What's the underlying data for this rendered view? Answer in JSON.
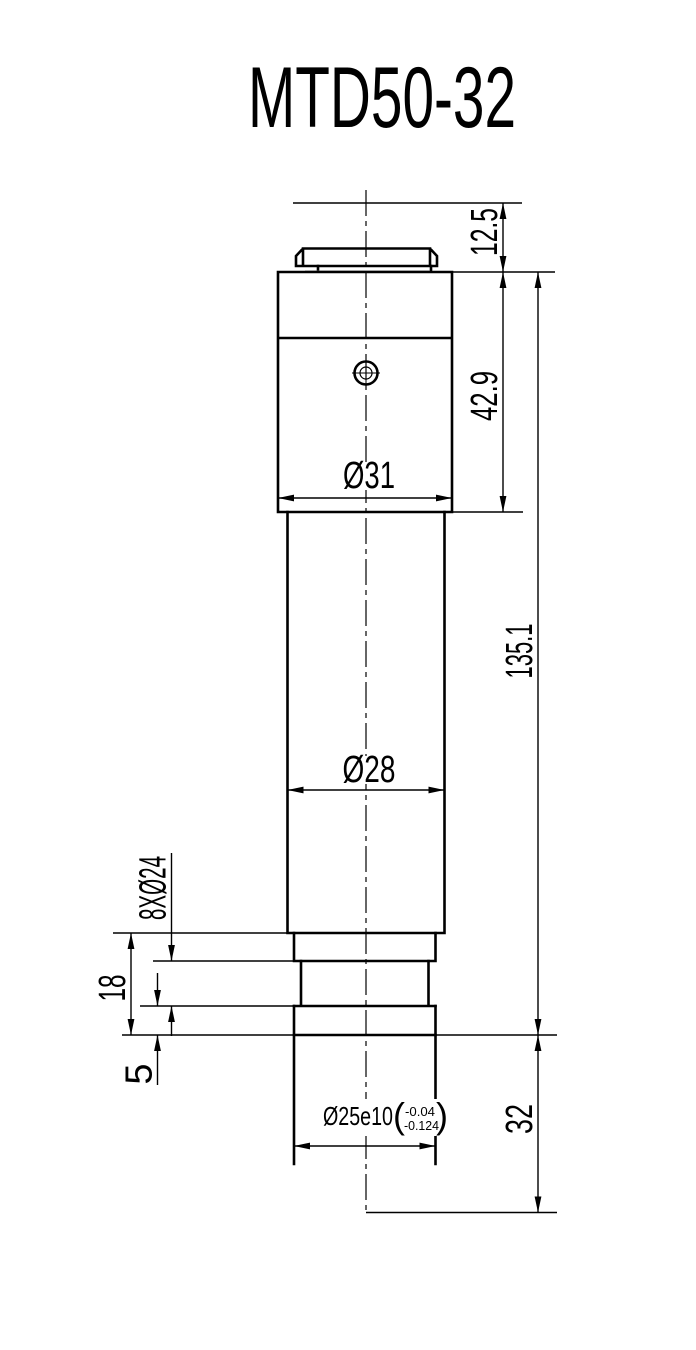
{
  "title": "MTD50-32",
  "dims": {
    "cap_height": "12.5",
    "head_height": "42.9",
    "head_diameter": "Ø31",
    "overall_length": "135.1",
    "tube_diameter": "Ø28",
    "flange_callout": "8XØ24",
    "flange_height": "18",
    "ring_height": "5",
    "spigot_diameter": "Ø25e10",
    "spigot_tol_upper": "-0.04",
    "spigot_tol_lower": "-0.124",
    "paren_open": "(",
    "paren_close": ")",
    "spigot_length": "32"
  }
}
